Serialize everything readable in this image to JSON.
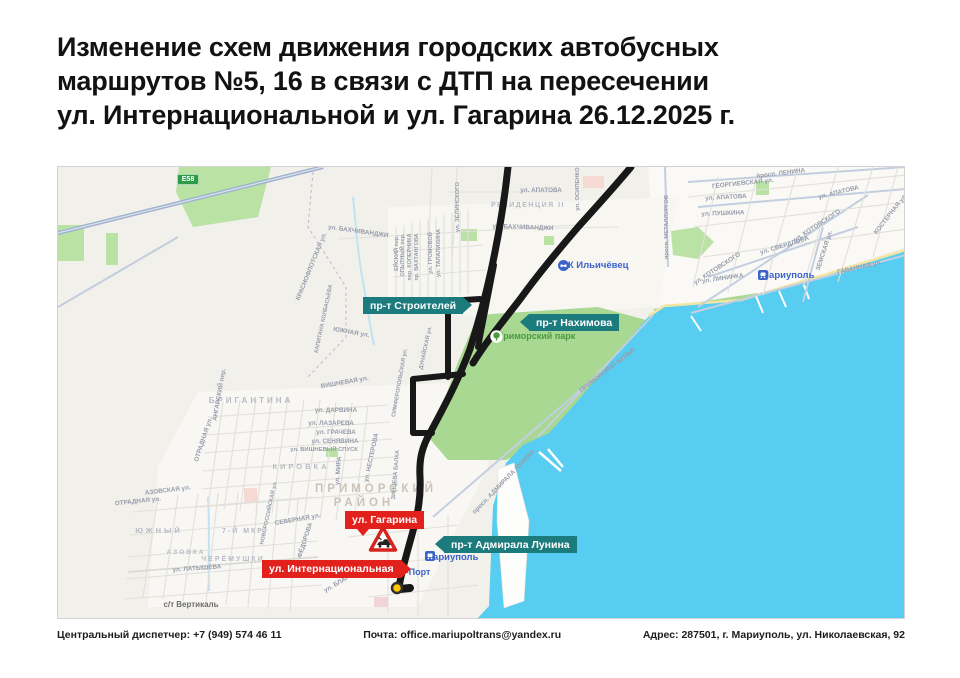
{
  "title": {
    "text": "Изменение схем движения городских автобусных\nмаршрутов №5, 16 в связи с ДТП на пересечении\nул. Интернациональной и ул. Гагарина 26.12.2025 г."
  },
  "footer": {
    "dispatcher": "Центральный диспетчер: +7 (949) 574 46 11",
    "email": "Почта: office.mariupoltrans@yandex.ru",
    "address": "Адрес: 287501, г. Мариуполь, ул. Николаевская, 92"
  },
  "colors": {
    "sea": "#57cdf1",
    "park": "#a9d893",
    "field": "#b9e2a4",
    "badge_teal": "#1b7b7d",
    "badge_red": "#e3211c",
    "poi_blue": "#3b63c9",
    "park_text": "#4a9b40",
    "label_gray": "#959cab",
    "district_gray": "#b7bbc5",
    "rayon_beige": "#cbc3ba",
    "route": "#181818",
    "road_blue": "#c3cfe0",
    "highway": "#9db1cc",
    "stream": "#bfe3f2",
    "beach": "#f3e6a3",
    "e58_green": "#2e9c47",
    "warning_red": "#d6231e",
    "terminus_yellow": "#ffc800"
  },
  "map": {
    "road_badge": "E58",
    "badges": {
      "stroiteley": {
        "label": "пр-т Строителей"
      },
      "nakhimova": {
        "label": "пр-т Нахимова"
      },
      "lunina": {
        "label": "пр-т Адмирала Лунина"
      },
      "gagarina": {
        "label": "ул. Гагарина"
      },
      "internatsionalnaya": {
        "label": "ул. Интернациональная"
      }
    },
    "pois": {
      "sk_ilyichevets": {
        "label": "СК Ильичёвец"
      },
      "primorsky_park": {
        "label": "Приморский парк"
      },
      "mariupol_ne": {
        "label": "Мариуполь"
      },
      "mariupol_port_station": {
        "label": "Мариуполь"
      },
      "mariupol_port": {
        "label": "Мариуполь-Порт"
      }
    },
    "district_labels": [
      {
        "t": "РЕЗИДЕНЦИЯ II",
        "x": 470,
        "y": 40,
        "s": 7,
        "ls": 1.5
      },
      {
        "t": "БРИГАНТИНА",
        "x": 193,
        "y": 236,
        "s": 8,
        "ls": 3
      },
      {
        "t": "КИРОВКА",
        "x": 243,
        "y": 302,
        "s": 7.5,
        "ls": 3
      },
      {
        "t": "ПРИМОРСКИЙ",
        "x": 318,
        "y": 325,
        "s": 11.5,
        "ls": 4,
        "c": "#cbc3ba"
      },
      {
        "t": "РАЙОН",
        "x": 306,
        "y": 339,
        "s": 11.5,
        "ls": 4,
        "c": "#cbc3ba"
      },
      {
        "t": "ЮЖНЫЙ",
        "x": 101,
        "y": 366,
        "s": 7.5,
        "ls": 3
      },
      {
        "t": "7-Й МКР",
        "x": 185,
        "y": 366,
        "s": 7,
        "ls": 2
      },
      {
        "t": "ЧЕРЁМУШКИ",
        "x": 175,
        "y": 394,
        "s": 7,
        "ls": 2
      },
      {
        "t": "АЗОВКА",
        "x": 128,
        "y": 387,
        "s": 6.5,
        "ls": 2
      },
      {
        "t": "с/т Вертикаль",
        "x": 133,
        "y": 440,
        "s": 8,
        "ls": 0,
        "c": "#6b6b6b"
      }
    ],
    "street_labels": [
      {
        "t": "КРАСНОФЛОТСКАЯ ул.",
        "x": 255,
        "y": 100,
        "r": -68
      },
      {
        "t": "ул. БАХЧИВАНДЖИ",
        "x": 300,
        "y": 66,
        "r": 8
      },
      {
        "t": "ул. БАХЧИВАНДЖИ",
        "x": 465,
        "y": 62,
        "r": 2
      },
      {
        "t": "ул. АПАТОВА",
        "x": 483,
        "y": 25
      },
      {
        "t": "ул. ЗЕЛИНСКОГО",
        "x": 401,
        "y": 40,
        "r": -90,
        "s": 5.8
      },
      {
        "t": "ЕЙСКИЙ пер.",
        "x": 340,
        "y": 86,
        "r": -90,
        "s": 5.5
      },
      {
        "t": "ОПЫТНЫЙ пер.",
        "x": 346,
        "y": 88,
        "r": -90,
        "s": 5.5
      },
      {
        "t": "пер. КОПЕРНИКА",
        "x": 353,
        "y": 90,
        "r": -90,
        "s": 5.5
      },
      {
        "t": "пр. ВАХТАНГОВА",
        "x": 360,
        "y": 90,
        "r": -90,
        "s": 5.5
      },
      {
        "t": "ул. ГРОМОВОЙ",
        "x": 374,
        "y": 86,
        "r": -90,
        "s": 5.5
      },
      {
        "t": "ул. ТАЛАЛИХИНА",
        "x": 382,
        "y": 86,
        "r": -90,
        "s": 5.5
      },
      {
        "t": "ул. ОСИПЕНКО",
        "x": 521,
        "y": 22,
        "r": -90,
        "s": 5.8
      },
      {
        "t": "просп. МЕТАЛЛУРГОВ",
        "x": 610,
        "y": 60,
        "r": -90,
        "s": 5.8
      },
      {
        "t": "просп. ЛЕНИНА",
        "x": 723,
        "y": 8,
        "r": -7
      },
      {
        "t": "ГЕОРГИЕВСКАЯ ул.",
        "x": 685,
        "y": 18,
        "r": -6
      },
      {
        "t": "ул. АПАТОВА",
        "x": 668,
        "y": 32,
        "r": -3
      },
      {
        "t": "ул. АПАТОВА",
        "x": 781,
        "y": 27,
        "r": -14
      },
      {
        "t": "ул. ПУШКИНА",
        "x": 665,
        "y": 48,
        "r": -2
      },
      {
        "t": "ул. КОТОВСКОГО",
        "x": 760,
        "y": 60,
        "r": -33
      },
      {
        "t": "ул. КОТОВСКОГО",
        "x": 660,
        "y": 103,
        "r": -33
      },
      {
        "t": "ул. СВЕРДЛОВА",
        "x": 727,
        "y": 80,
        "r": -17
      },
      {
        "t": "ЗЕМСКАЯ ул.",
        "x": 768,
        "y": 84,
        "r": -72
      },
      {
        "t": "ГАВАННАЯ ул.",
        "x": 802,
        "y": 102,
        "r": -13
      },
      {
        "t": "ул. ЛИНИНКА",
        "x": 665,
        "y": 113,
        "r": -8
      },
      {
        "t": "КОСТЕРНАЯ ул.",
        "x": 834,
        "y": 48,
        "r": -52
      },
      {
        "t": "ОТРАДНАЯ ул.",
        "x": 147,
        "y": 273,
        "r": -72
      },
      {
        "t": "ОТРАДНАЯ ул.",
        "x": 80,
        "y": 336,
        "r": -6
      },
      {
        "t": "АЗОВСКАЯ ул.",
        "x": 110,
        "y": 325,
        "r": -7
      },
      {
        "t": "АНГАРСКИЙ пер.",
        "x": 163,
        "y": 228,
        "r": -80
      },
      {
        "t": "ВИШНЕВАЯ ул.",
        "x": 287,
        "y": 217,
        "r": -10
      },
      {
        "t": "ул. ДАРВИНА",
        "x": 278,
        "y": 245
      },
      {
        "t": "ул. ЛАЗАРЕВА",
        "x": 273,
        "y": 258
      },
      {
        "t": "ул. ГРАЧЕВА",
        "x": 278,
        "y": 267
      },
      {
        "t": "ул. СЕНЯВИНА",
        "x": 277,
        "y": 276
      },
      {
        "t": "ул. ВИШНЕВЫЙ СПУСК",
        "x": 266,
        "y": 284,
        "s": 5.8
      },
      {
        "t": "ул. МИРА",
        "x": 282,
        "y": 304,
        "r": -85
      },
      {
        "t": "ул. НЕСТЕРОВА",
        "x": 315,
        "y": 291,
        "r": -78
      },
      {
        "t": "ЗИНЦЕВА БАЛКА",
        "x": 339,
        "y": 308,
        "r": -85,
        "s": 5.8
      },
      {
        "t": "СИМФЕРОПОЛЬСКАЯ ул.",
        "x": 343,
        "y": 216,
        "r": -80,
        "s": 5.5
      },
      {
        "t": "ДУНАЙСКАЯ ул.",
        "x": 369,
        "y": 181,
        "r": -78,
        "s": 5.5
      },
      {
        "t": "просп. АДМИРАЛА ЛУНИНА",
        "x": 447,
        "y": 316,
        "r": -46
      },
      {
        "t": "ПРИМОРСКИЙ БУЛЬВ.",
        "x": 551,
        "y": 204,
        "r": -38
      },
      {
        "t": "СЕВЕРНАЯ ул.",
        "x": 240,
        "y": 354,
        "r": -10
      },
      {
        "t": "НОВОРОССИЙСКАЯ ул.",
        "x": 212,
        "y": 346,
        "r": -78,
        "s": 5.5
      },
      {
        "t": "ул. ЛАТЫШЕВА",
        "x": 139,
        "y": 403,
        "r": -4
      },
      {
        "t": "ул. ФЁДОРОВА",
        "x": 247,
        "y": 379,
        "r": -72
      },
      {
        "t": "ул. БЛАГОЕВА",
        "x": 287,
        "y": 414,
        "r": -30
      },
      {
        "t": "КАПИТАНА КОЛБАСЬЕВА",
        "x": 267,
        "y": 152,
        "r": -78,
        "s": 5.5
      },
      {
        "t": "ЮЖНАЯ ул.",
        "x": 293,
        "y": 167,
        "r": 10
      }
    ]
  }
}
